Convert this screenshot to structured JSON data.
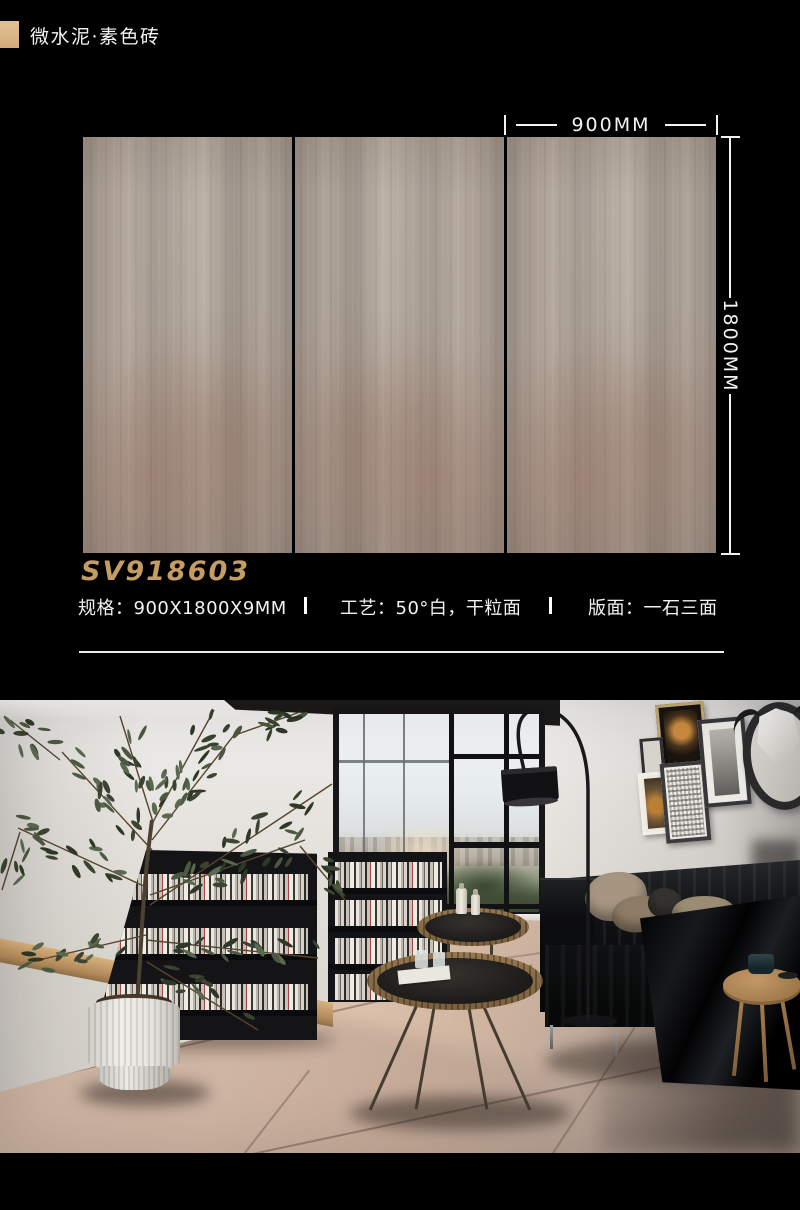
{
  "header": {
    "title": "微水泥·素色砖",
    "swatch_color": "#d8b586"
  },
  "dimensions": {
    "width_label": "900MM",
    "height_label": "1800MM"
  },
  "product": {
    "code": "SV918603",
    "code_color": "#c59d63",
    "specs": [
      {
        "label": "规格：900X1800X9MM"
      },
      {
        "label": "工艺：50°白，干粒面"
      },
      {
        "label": "版面：一石三面"
      }
    ]
  },
  "tiles": {
    "panel_count": 3,
    "surface_color": "#a89c92"
  },
  "scene": {
    "objects": [
      "olive-tree",
      "ribbed-planter",
      "leaning-bookshelf",
      "bookshelf",
      "arc-floor-lamp",
      "black-leather-sofa",
      "cushions",
      "gallery-frames",
      "bull-skull-mirror",
      "round-coffee-tables",
      "wood-side-table",
      "window-city-view",
      "tile-floor"
    ],
    "floor_color": "#c7af9f"
  },
  "page": {
    "background": "#000000"
  }
}
